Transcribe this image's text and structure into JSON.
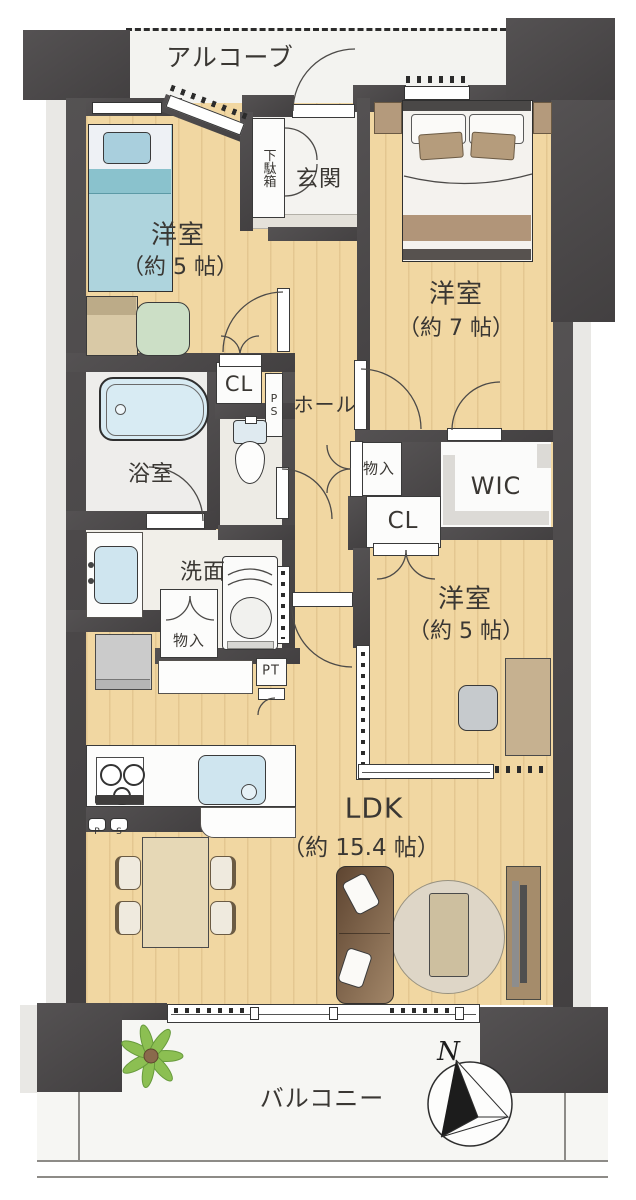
{
  "colors": {
    "wall": "#4a4748",
    "wood_floor": "#f1d7a2",
    "water_blue": "#cfe6ef",
    "bed_teal": "#a7d1db",
    "sofa_brown": "#6b5038",
    "rug_beige": "#ded6c7",
    "plant_green": "#8cbf52",
    "balcony_white": "#f6f6f3"
  },
  "rooms": {
    "alcove": {
      "label": "アルコーブ"
    },
    "bedroom1": {
      "label": "洋室",
      "size": "（約 5 帖）"
    },
    "bedroom2": {
      "label": "洋室",
      "size": "（約 7 帖）"
    },
    "bedroom3": {
      "label": "洋室",
      "size": "（約 5 帖）"
    },
    "ldk": {
      "label": "LDK",
      "size": "（約 15.4 帖）"
    },
    "genkan": {
      "label": "玄関"
    },
    "hall": {
      "label": "ホール"
    },
    "bath": {
      "label": "浴室"
    },
    "washroom": {
      "label": "洗面"
    },
    "balcony": {
      "label": "バルコニー"
    }
  },
  "storage": {
    "shoe_cabinet": "下駄箱",
    "closet_upper": "CL",
    "closet_middle": "CL",
    "wic": "WIC",
    "storage_hall": "物入",
    "storage_washroom": "物入",
    "pipe_shaft": "PS",
    "pipe_space_p": "P",
    "pipe_space_s": "S",
    "pipe_trunk": "PT"
  },
  "compass": {
    "north_label": "N"
  }
}
